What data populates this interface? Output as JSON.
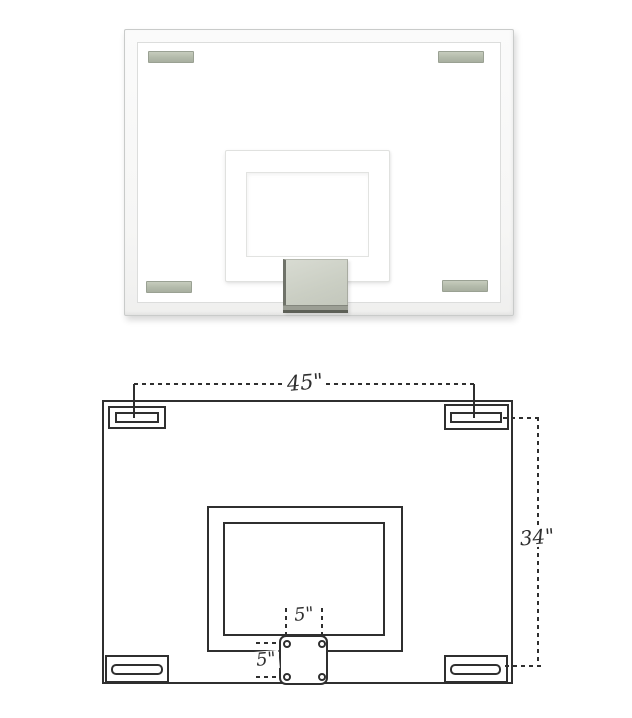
{
  "photo": {
    "subject": "glass basketball backboard with white frame, four mounting pads, shooter square and lower mounting plate",
    "colors": {
      "frame": "#f7f7f6",
      "pad": "#b3baaa",
      "plate": "#c9cdc2"
    }
  },
  "diagram": {
    "subject": "backboard mounting dimension drawing",
    "line_color": "#2f2f2f",
    "labels": {
      "width": "45\"",
      "height": "34\"",
      "bolt_spacing_horizontal": "5\"",
      "bolt_spacing_vertical": "5\""
    }
  }
}
